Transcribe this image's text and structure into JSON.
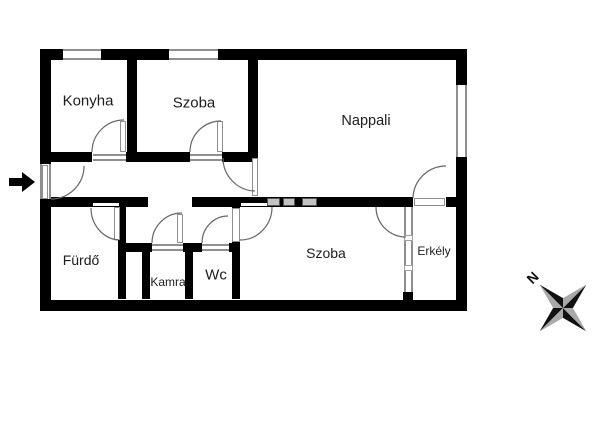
{
  "plan": {
    "type": "apartment-floor-plan",
    "rooms": [
      {
        "id": "konyha",
        "label": "Konyha"
      },
      {
        "id": "szoba-top",
        "label": "Szoba"
      },
      {
        "id": "nappali",
        "label": "Nappali"
      },
      {
        "id": "furdo",
        "label": "Fürdő"
      },
      {
        "id": "kamra",
        "label": "Kamra"
      },
      {
        "id": "wc",
        "label": "Wc"
      },
      {
        "id": "szoba-bottom",
        "label": "Szoba"
      },
      {
        "id": "erkely",
        "label": "Erkély"
      }
    ],
    "compass": {
      "north_label": "N"
    },
    "colors": {
      "wall": "#000000",
      "door_window_line": "#8f8f8f",
      "compass_dark": "#111111",
      "compass_light": "#a9a9a9"
    },
    "icons": {
      "entrance_arrow": "right-arrow"
    }
  }
}
